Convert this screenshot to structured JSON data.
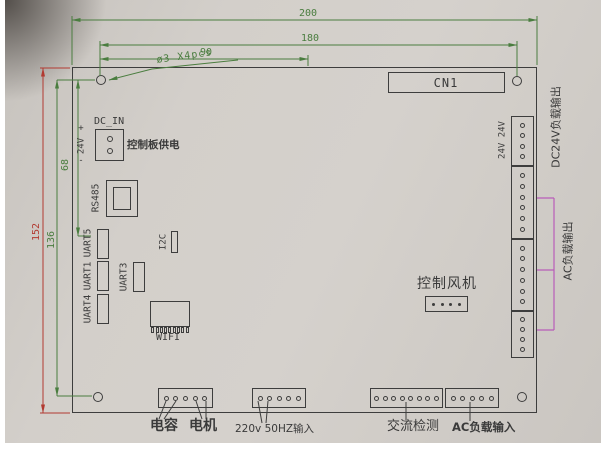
{
  "drawing": {
    "type": "pcb-dimension-diagram",
    "colors": {
      "background": "#d1cdc8",
      "line": "#3d3d3d",
      "dimension_green": "#4a7d3f",
      "dimension_red": "#b23a31",
      "bracket_magenta": "#b95db9"
    },
    "dimensions": {
      "top_width": "200",
      "hole_span_width": "180",
      "hole_offset_width": "90",
      "left_height": "152",
      "hole_span_height": "136",
      "dcin_offset_height": "68",
      "hole_note": "ø3 X4pcs"
    },
    "components": {
      "cn1_label": "CN1",
      "dc_in_label": "DC_IN",
      "dc_in_plus": "+",
      "dc_in_voltage": "24V",
      "dc_in_minus": "-",
      "dc_in_note": "控制板供电",
      "rs485_label": "RS485",
      "uart5_label": "UART5",
      "uart1_label": "UART1",
      "uart4_label": "UART4",
      "uart3_label": "UART3",
      "i2c_label": "I2C",
      "wifi_label": "WIFI",
      "fan_label": "控制风机",
      "v24_label": "24V 24V"
    },
    "right_margin_labels": {
      "dc24v_output": "DC24V负载输出",
      "ac_output": "AC负载输出"
    },
    "bottom_labels": {
      "capacitor": "电容",
      "motor": "电机",
      "mains_input": "220v 50HZ输入",
      "ac_detect": "交流检测",
      "ac_load_input": "AC负载输入"
    },
    "connectors": {
      "dc_in_pins": 2,
      "fan_pins": 4,
      "wifi_teeth": 9,
      "right_blocks": [
        {
          "pins": 4
        },
        {
          "pins": 6
        },
        {
          "pins": 6
        },
        {
          "pins": 4
        }
      ],
      "bottom_blocks": [
        {
          "pins": 5
        },
        {
          "pins": 5
        },
        {
          "pins": 8
        },
        {
          "pins": 5
        }
      ]
    }
  }
}
